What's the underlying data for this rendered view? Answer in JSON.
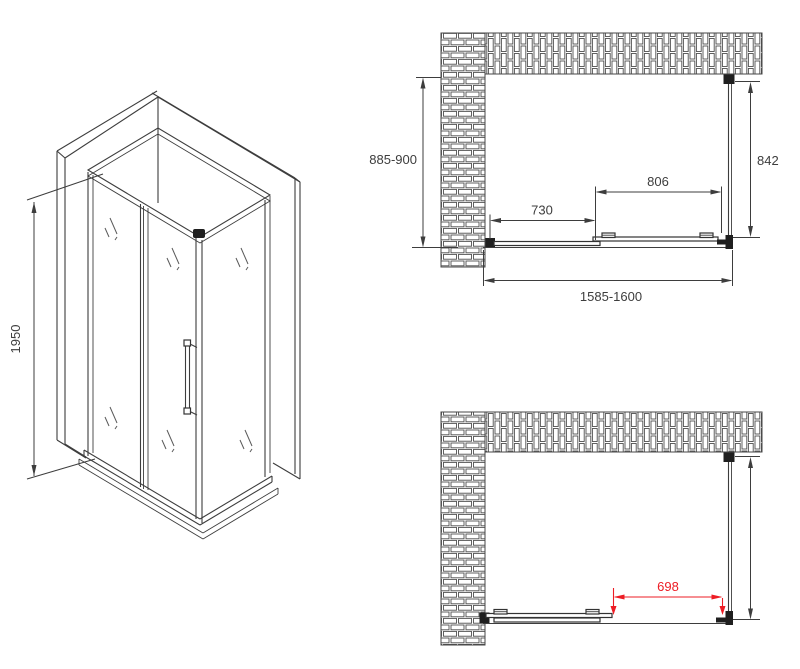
{
  "drawing": {
    "kind": "shower-enclosure-technical-drawing",
    "views": {
      "isometric": "3d-view",
      "plan_closed": "top-view-door-closed",
      "plan_open": "top-view-door-open"
    }
  },
  "dims": {
    "iso_height": "1950",
    "plan": {
      "side_depth_range": "885-900",
      "glass_depth": "842",
      "door_width": "806",
      "fixed_panel_width": "730",
      "total_width_range": "1585-1600",
      "opening_width": "698"
    }
  },
  "colors": {
    "line": "#3d3d3d",
    "accent_red": "#ed1c24",
    "brick_outline": "#4f4f4f",
    "background": "#ffffff"
  }
}
